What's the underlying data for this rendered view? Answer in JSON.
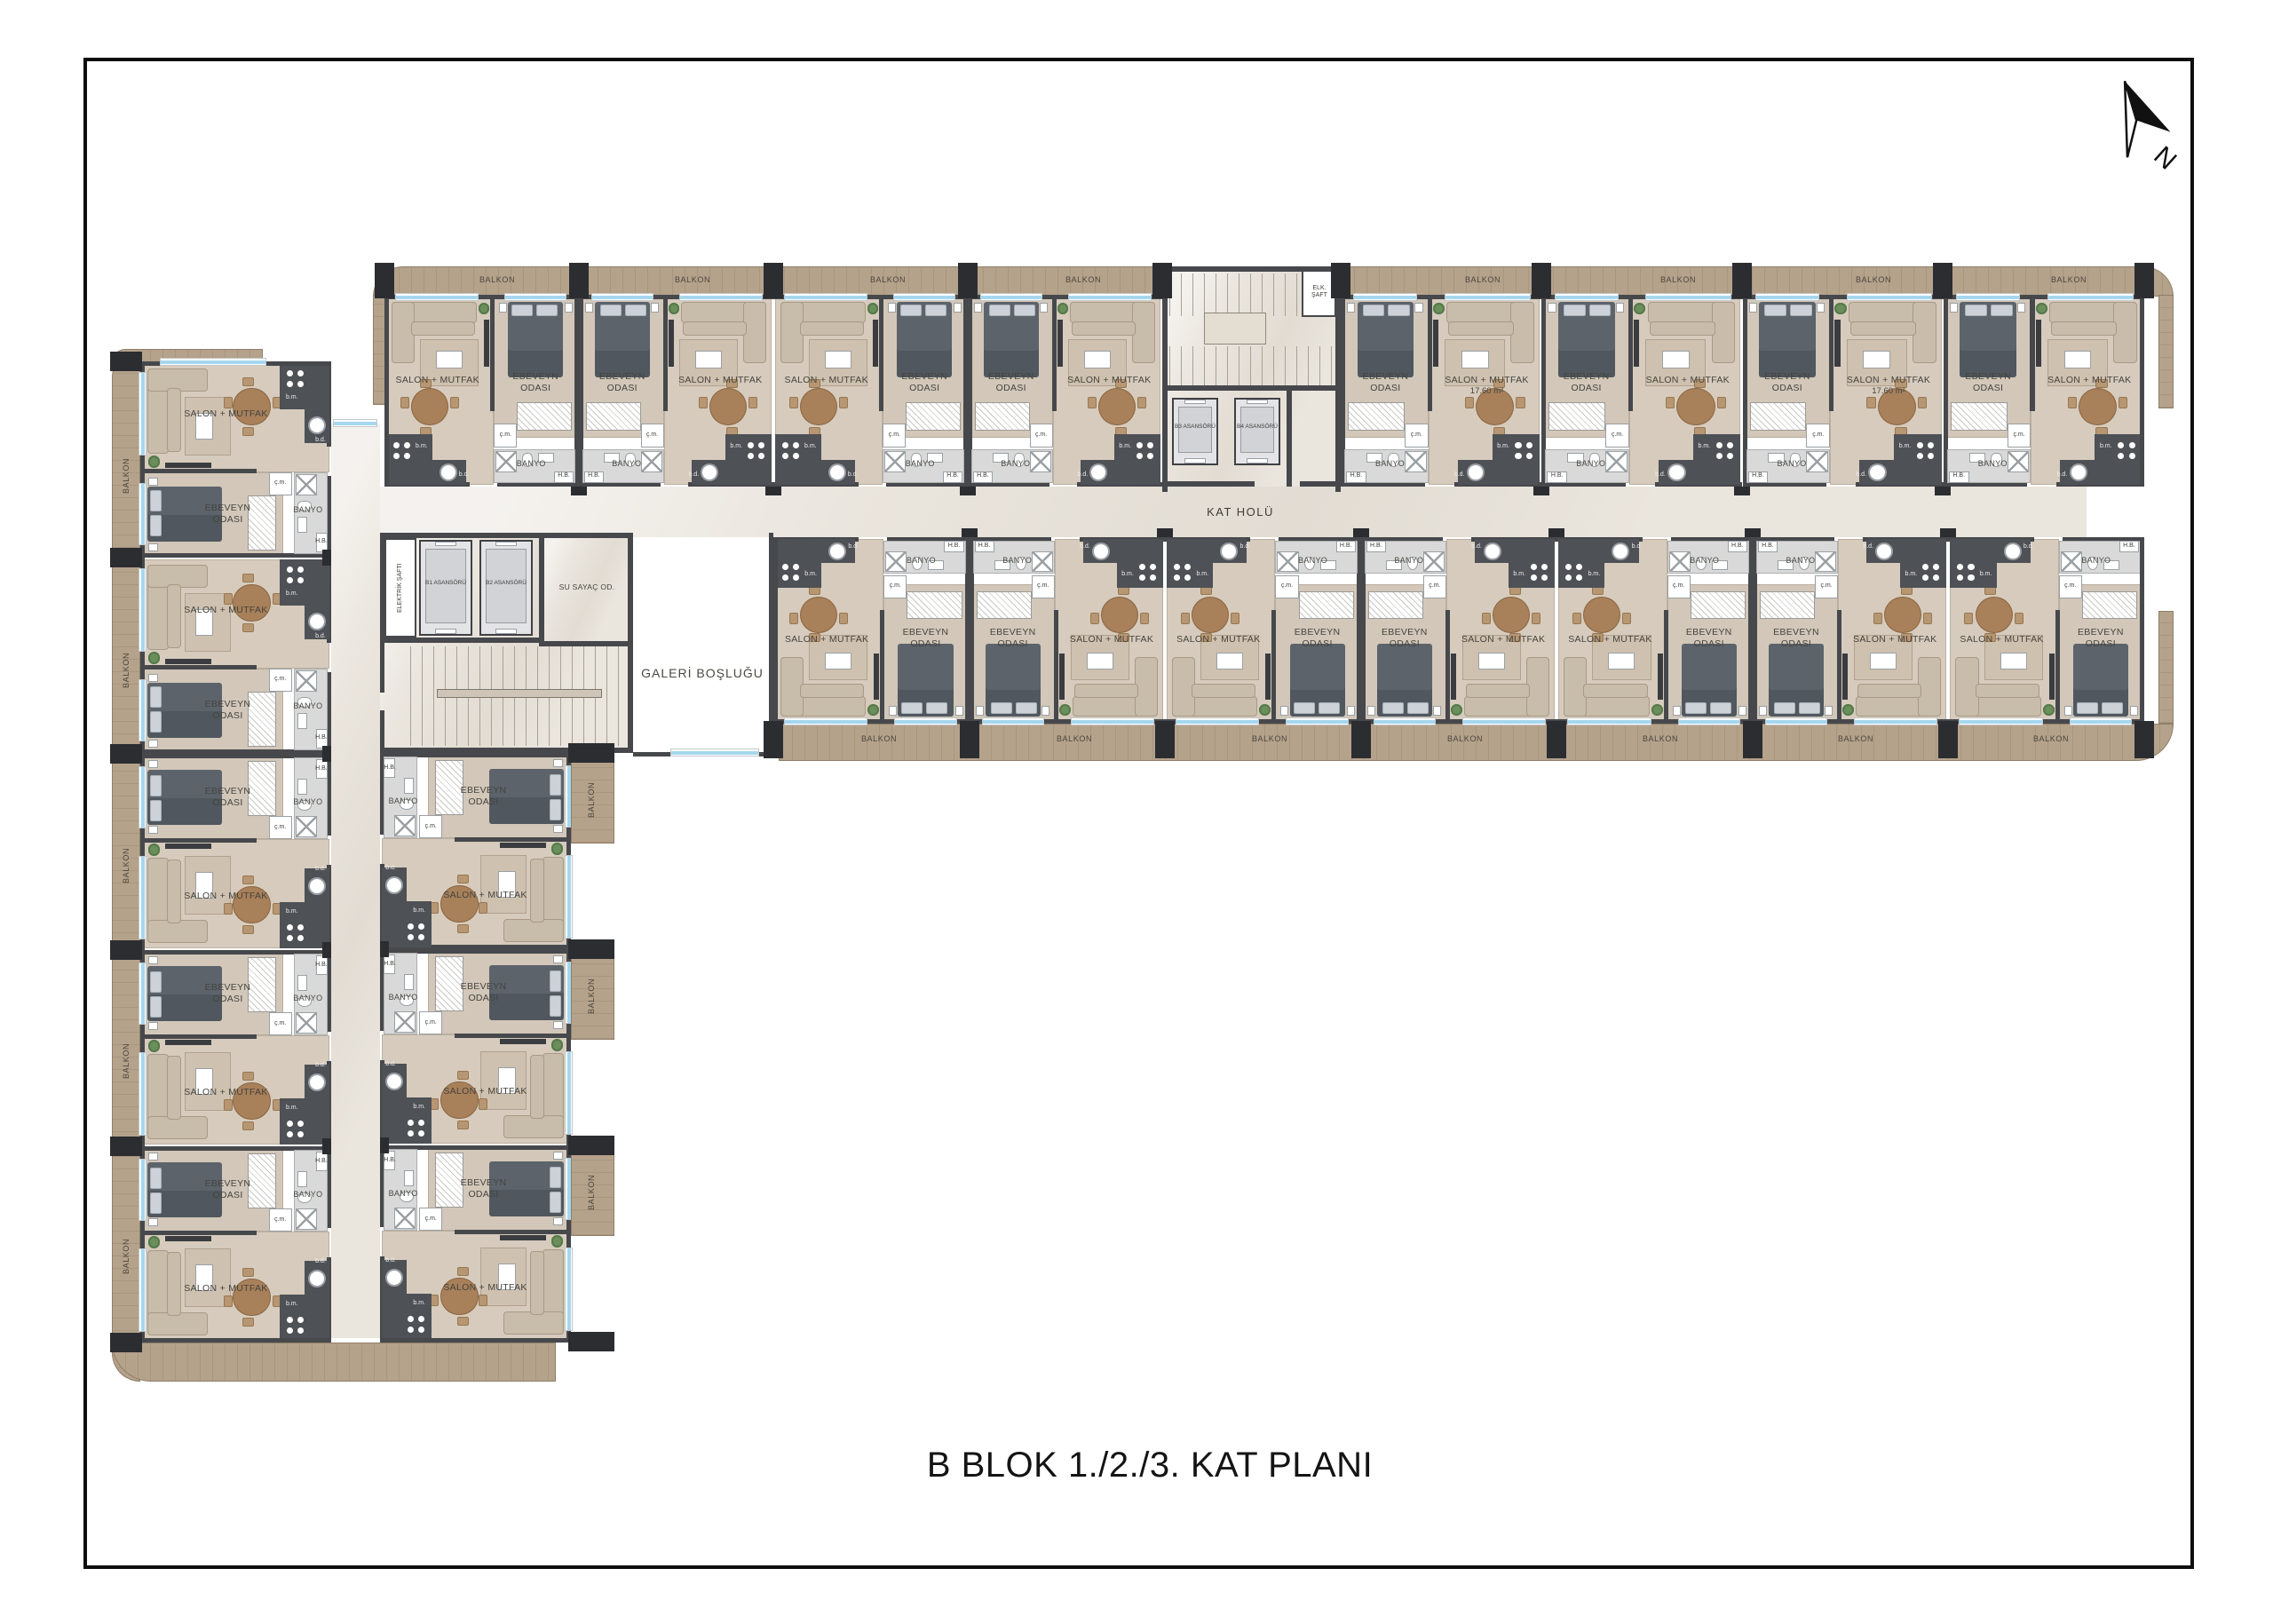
{
  "title": "B BLOK 1./2./3. KAT PLANI",
  "compass": {
    "label": "N"
  },
  "labels": {
    "balcony": "BALKON",
    "salon": "SALON + MUTFAK",
    "salon_area": "17.60 m²",
    "bedroom": "EBEVEYN ODASI",
    "bath": "BANYO",
    "cm": "ç.m.",
    "bm": "b.m.",
    "bd": "b.d.",
    "hb": "H.B.",
    "hall": "KAT HOLÜ",
    "gallery": "GALERİ BOŞLUĞU",
    "water_meter": "SU SAYAÇ OD.",
    "electric_shaft": "ELEKTRİK ŞAFTI",
    "elk_shaft": "ELK. ŞAFT"
  },
  "elevators": [
    {
      "name": "B1 ASANSÖRÜ"
    },
    {
      "name": "B2 ASANSÖRÜ"
    },
    {
      "name": "B3 ASANSÖRÜ"
    },
    {
      "name": "B4 ASANSÖRÜ"
    }
  ],
  "top_wing": {
    "top_row_units": [
      {
        "type": "SE",
        "area": false
      },
      {
        "type": "ES",
        "area": false
      },
      {
        "type": "SE",
        "area": false
      },
      {
        "type": "ES",
        "area": false
      },
      {
        "type": "ES",
        "area": true
      },
      {
        "type": "ES",
        "area": false
      },
      {
        "type": "ES",
        "area": true
      },
      {
        "type": "ES",
        "area": false
      }
    ],
    "bottom_row_units": [
      {
        "type": "SE",
        "area": false
      },
      {
        "type": "ES",
        "area": false
      },
      {
        "type": "SE",
        "area": false
      },
      {
        "type": "ES",
        "area": false
      },
      {
        "type": "SE",
        "area": false
      },
      {
        "type": "ES",
        "area": false
      },
      {
        "type": "SE",
        "area": false
      }
    ]
  },
  "left_wing": {
    "left_col_units": [
      {
        "type": "SE",
        "area": false
      },
      {
        "type": "SE",
        "area": false
      },
      {
        "type": "ES",
        "area": false
      },
      {
        "type": "ES",
        "area": false
      },
      {
        "type": "ES",
        "area": false
      }
    ],
    "right_col_units": [
      {
        "type": "ES",
        "area": false
      },
      {
        "type": "ES",
        "area": false
      },
      {
        "type": "ES",
        "area": false
      }
    ]
  },
  "colors": {
    "wall": "#46484c",
    "column": "#2b2d31",
    "balcony_wood": "#b5a28b",
    "window_glass": "#a6d7ee",
    "floor_unit": "#d6cbbd",
    "floor_corridor": "#eae5dd",
    "bathroom": "#d9d9d9",
    "bed": "#5c636b",
    "sofa": "#c8bcaa",
    "table_wood": "#a8805a",
    "void": "#ffffff"
  }
}
